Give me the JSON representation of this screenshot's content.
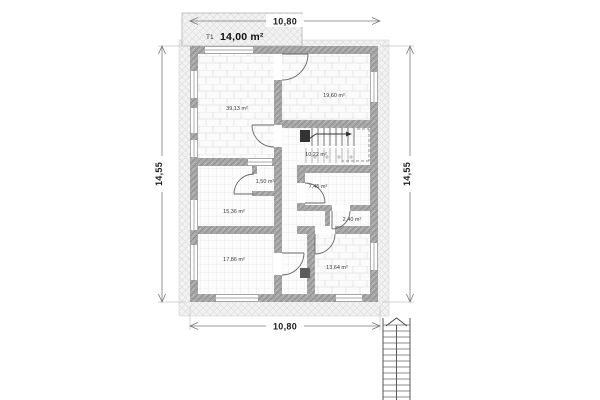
{
  "plan": {
    "terrace": {
      "code": "T1",
      "area": "14,00 m²"
    },
    "dimensions": {
      "top": "10,80",
      "bottom": "10,80",
      "left": "14,55",
      "right": "14,55"
    },
    "rooms": {
      "top_left": {
        "label": "39,13 m²"
      },
      "top_right": {
        "label": "19,60 m²"
      },
      "stair_hall": {
        "label": "10,22 m²"
      },
      "mid_left": {
        "label": "15,36 m²"
      },
      "wc": {
        "label": "1,50 m²"
      },
      "bath": {
        "label": "7,45 m²"
      },
      "closet": {
        "label": "2,40 m²"
      },
      "bottom_left": {
        "label": "17,86 m²"
      },
      "bottom_right": {
        "label": "13,64 m²"
      }
    }
  }
}
